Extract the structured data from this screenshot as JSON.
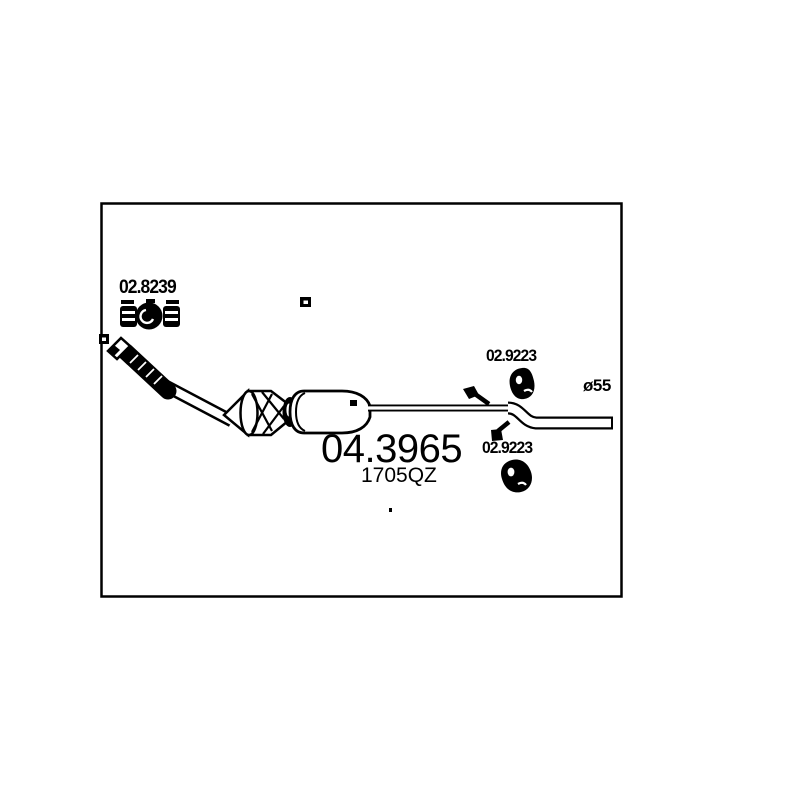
{
  "drawing": {
    "clamp_label": "02.8239",
    "hanger_top_label": "02.9223",
    "hanger_bottom_label": "02.9223",
    "diameter_label": "ø55",
    "main_part_number": "04.3965",
    "oe_code": "1705QZ"
  },
  "icons": [
    "pipe-clamp-icon",
    "rubber-hanger-icon-top",
    "rubber-hanger-icon-bottom",
    "exhaust-system-drawing"
  ],
  "colors": {
    "ink": "#000000",
    "background": "#ffffff"
  }
}
